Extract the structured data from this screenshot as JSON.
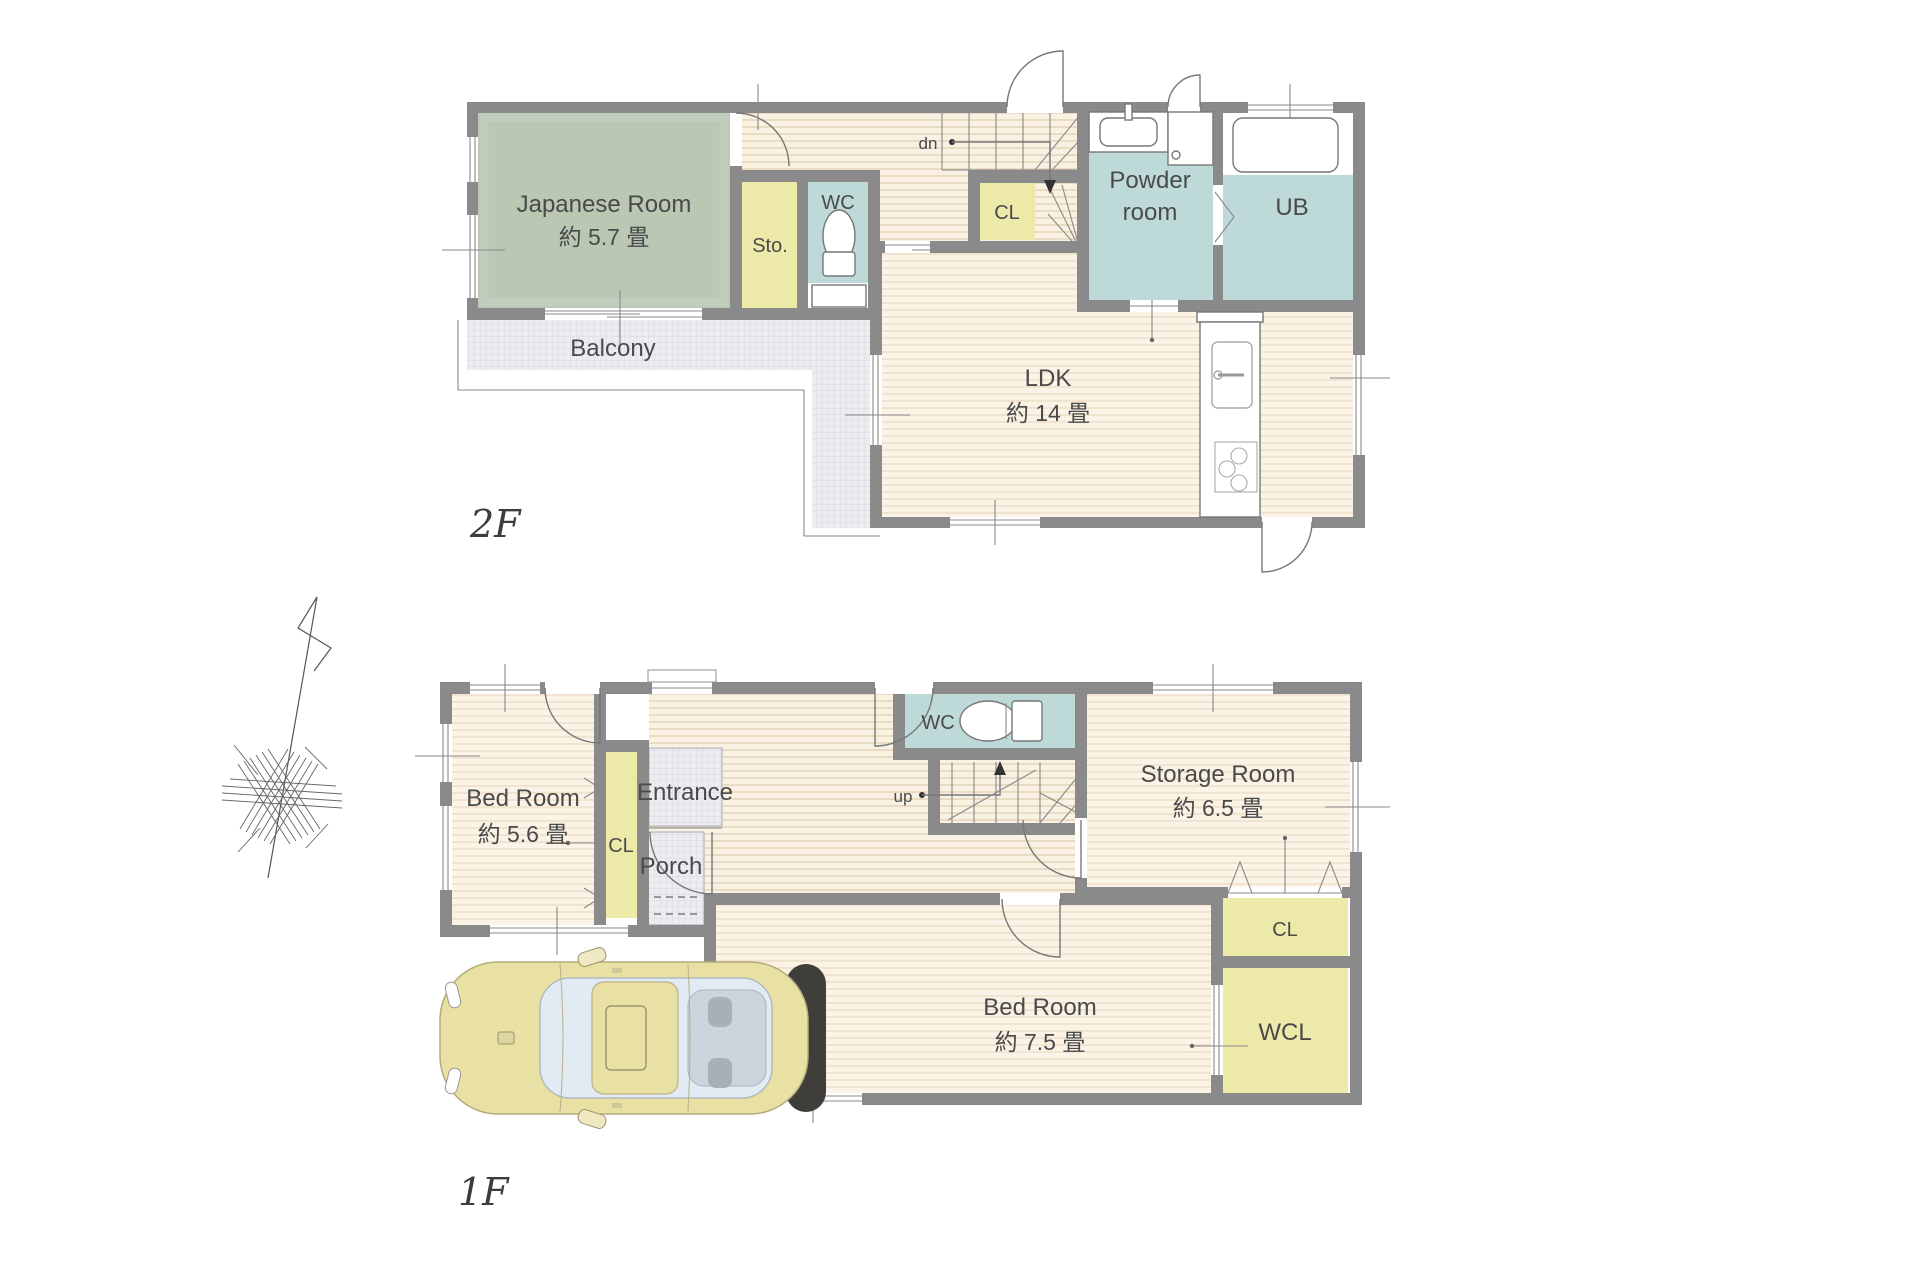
{
  "document": {
    "type": "floor-plan",
    "floor_labels": {
      "second": "2F",
      "first": "1F"
    }
  },
  "floors": {
    "f2": {
      "label": "2F",
      "rooms": {
        "japanese": {
          "name": "Japanese Room",
          "area": "約 5.7 畳"
        },
        "sto": {
          "name": "Sto."
        },
        "wc": {
          "name": "WC"
        },
        "cl": {
          "name": "CL"
        },
        "stair_direction": "dn",
        "powder": {
          "line1": "Powder",
          "line2": "room"
        },
        "ub": {
          "name": "UB"
        },
        "ldk": {
          "name": "LDK",
          "area": "約 14 畳"
        },
        "balcony": {
          "name": "Balcony"
        }
      }
    },
    "f1": {
      "label": "1F",
      "rooms": {
        "bedroom_small": {
          "name": "Bed Room",
          "area": "約 5.6 畳"
        },
        "cl_left": {
          "name": "CL"
        },
        "entrance": {
          "name": "Entrance"
        },
        "porch": {
          "name": "Porch"
        },
        "wc": {
          "name": "WC"
        },
        "stair_direction": "up",
        "storage": {
          "name": "Storage Room",
          "area": "約 6.5 畳"
        },
        "cl_right": {
          "name": "CL"
        },
        "wcl": {
          "name": "WCL"
        },
        "bedroom_large": {
          "name": "Bed Room",
          "area": "約 7.5 畳"
        }
      }
    }
  },
  "palette": {
    "wall_gray": "#8a8a8a",
    "tatami_green": "#b9c7b3",
    "closet_yellow": "#ece9a9",
    "wet_area_blue": "#bedad8",
    "floor_cream": "#f9f1e1",
    "exterior_gray": "#ececf1",
    "car_yellow": "#e9e0a3",
    "text_gray": "#4a4a4a"
  }
}
